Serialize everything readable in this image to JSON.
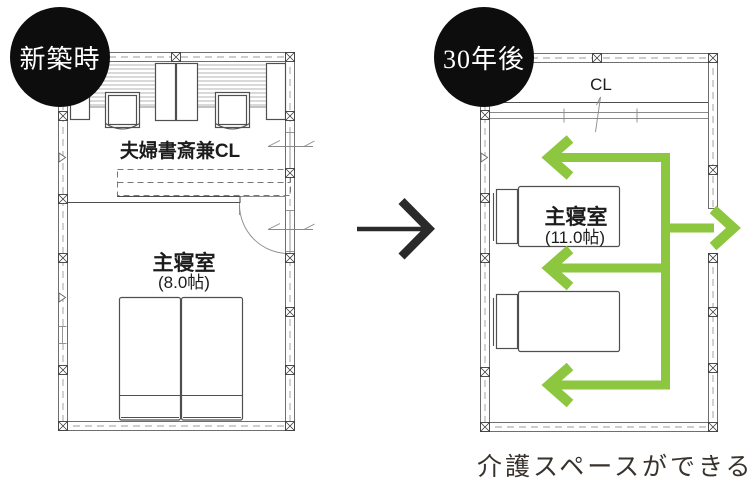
{
  "diagram": {
    "before": {
      "badge_label": "新築時",
      "study_room_label": "夫婦書斎兼CL",
      "bedroom_label": "主寝室",
      "bedroom_size": "(8.0帖)"
    },
    "after": {
      "badge_label": "30年後",
      "closet_label": "CL",
      "bedroom_label": "主寝室",
      "bedroom_size": "(11.0帖)"
    },
    "caption": "介護スペースができる",
    "colors": {
      "highlight_green": "#8dc63f",
      "badge_background": "#0d0d0d",
      "badge_text": "#ffffff",
      "transform_arrow_black": "#2a2a2a",
      "caption_text": "#38322d",
      "plan_wall_line": "#6e6e6e",
      "furniture_line": "#4f4f4f",
      "label_text": "#1c1c1c"
    }
  }
}
